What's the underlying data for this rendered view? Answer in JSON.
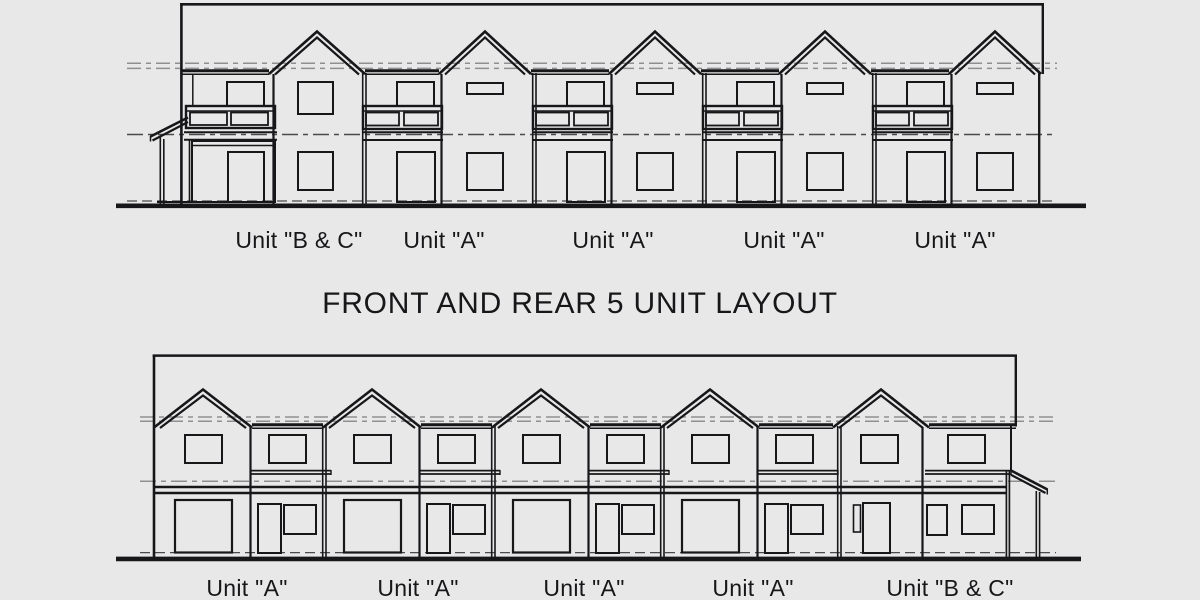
{
  "title": "FRONT AND REAR 5 UNIT LAYOUT",
  "top_elevation": {
    "unit_labels": [
      "Unit \"B & C\"",
      "Unit \"A\"",
      "Unit \"A\"",
      "Unit \"A\"",
      "Unit \"A\""
    ]
  },
  "bottom_elevation": {
    "unit_labels": [
      "Unit \"A\"",
      "Unit \"A\"",
      "Unit \"A\"",
      "Unit \"A\"",
      "Unit \"B & C\""
    ]
  },
  "colors": {
    "background": "#e8e8e8",
    "line": "#17171a",
    "reference_line": "#8f8f8f",
    "dark_reference_line": "#4a4a4a",
    "text": "#17171a"
  }
}
